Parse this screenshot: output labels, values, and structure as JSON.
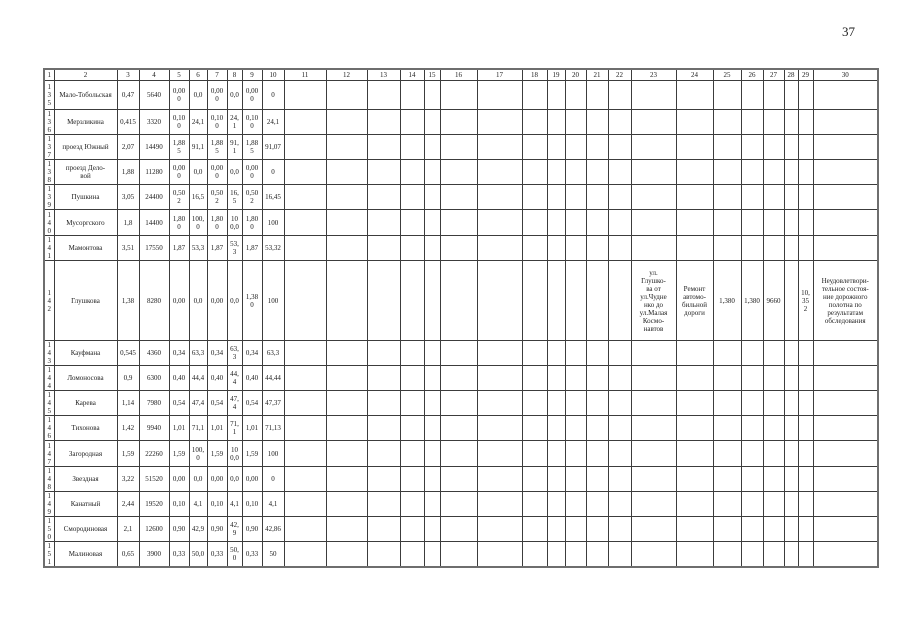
{
  "page": {
    "number": "37"
  },
  "table": {
    "header_cols": [
      "1",
      "2",
      "3",
      "4",
      "5",
      "6",
      "7",
      "8",
      "9",
      "10",
      "11",
      "12",
      "13",
      "14",
      "15",
      "16",
      "17",
      "18",
      "19",
      "20",
      "21",
      "22",
      "23",
      "24",
      "25",
      "26",
      "27",
      "28",
      "29",
      "30"
    ],
    "rows": [
      {
        "cells": [
          "135",
          "Мало-Тобольская",
          "0,47",
          "5640",
          "0,000",
          "0,0",
          "0,000",
          "0,0",
          "0,000",
          "0",
          "",
          "",
          "",
          "",
          "",
          "",
          "",
          "",
          "",
          "",
          "",
          "",
          "",
          "",
          "",
          "",
          "",
          "",
          "",
          ""
        ]
      },
      {
        "cells": [
          "136",
          "Мерзликина",
          "0,415",
          "3320",
          "0,100",
          "24,1",
          "0,100",
          "24,1",
          "0,100",
          "24,1",
          "",
          "",
          "",
          "",
          "",
          "",
          "",
          "",
          "",
          "",
          "",
          "",
          "",
          "",
          "",
          "",
          "",
          "",
          "",
          ""
        ]
      },
      {
        "cells": [
          "137",
          "проезд Южный",
          "2,07",
          "14490",
          "1,885",
          "91,1",
          "1,885",
          "91,1",
          "1,885",
          "91,07",
          "",
          "",
          "",
          "",
          "",
          "",
          "",
          "",
          "",
          "",
          "",
          "",
          "",
          "",
          "",
          "",
          "",
          "",
          "",
          ""
        ]
      },
      {
        "cells": [
          "138",
          "проезд Дело-\nвой",
          "1,88",
          "11280",
          "0,000",
          "0,0",
          "0,000",
          "0,0",
          "0,000",
          "0",
          "",
          "",
          "",
          "",
          "",
          "",
          "",
          "",
          "",
          "",
          "",
          "",
          "",
          "",
          "",
          "",
          "",
          "",
          "",
          ""
        ]
      },
      {
        "cells": [
          "139",
          "Пушкина",
          "3,05",
          "24400",
          "0,502",
          "16,5",
          "0,502",
          "16,5",
          "0,502",
          "16,45",
          "",
          "",
          "",
          "",
          "",
          "",
          "",
          "",
          "",
          "",
          "",
          "",
          "",
          "",
          "",
          "",
          "",
          "",
          "",
          ""
        ]
      },
      {
        "cells": [
          "140",
          "Мусоргского",
          "1,8",
          "14400",
          "1,800",
          "100,0",
          "1,800",
          "100,0",
          "1,800",
          "100",
          "",
          "",
          "",
          "",
          "",
          "",
          "",
          "",
          "",
          "",
          "",
          "",
          "",
          "",
          "",
          "",
          "",
          "",
          "",
          ""
        ]
      },
      {
        "cells": [
          "141",
          "Мамонтова",
          "3,51",
          "17550",
          "1,87",
          "53,3",
          "1,87",
          "53,3",
          "1,87",
          "53,32",
          "",
          "",
          "",
          "",
          "",
          "",
          "",
          "",
          "",
          "",
          "",
          "",
          "",
          "",
          "",
          "",
          "",
          "",
          "",
          ""
        ]
      },
      {
        "cells": [
          "142",
          "Глушкова",
          "1,38",
          "8280",
          "0,00",
          "0,0",
          "0,00",
          "0,0",
          "1,380",
          "100",
          "",
          "",
          "",
          "",
          "",
          "",
          "",
          "",
          "",
          "",
          "",
          "",
          "ул.\nГлушко-\nва от\nул.Чудне\nнко до\nул.Малая\nКосмо-\nнавтов",
          "Ремонт\nавтомо-\nбильной\nдороги",
          "1,380",
          "1,380",
          "9660",
          "",
          "10,352",
          "Неудовлетвори-\nтельное состоя-\nние дорожного\nполотна по\nрезультатам\nобследования"
        ]
      },
      {
        "cells": [
          "143",
          "Кауфмана",
          "0,545",
          "4360",
          "0,34",
          "63,3",
          "0,34",
          "63,3",
          "0,34",
          "63,3",
          "",
          "",
          "",
          "",
          "",
          "",
          "",
          "",
          "",
          "",
          "",
          "",
          "",
          "",
          "",
          "",
          "",
          "",
          "",
          ""
        ]
      },
      {
        "cells": [
          "144",
          "Ломоносова",
          "0,9",
          "6300",
          "0,40",
          "44,4",
          "0,40",
          "44,4",
          "0,40",
          "44,44",
          "",
          "",
          "",
          "",
          "",
          "",
          "",
          "",
          "",
          "",
          "",
          "",
          "",
          "",
          "",
          "",
          "",
          "",
          "",
          ""
        ]
      },
      {
        "cells": [
          "145",
          "Карева",
          "1,14",
          "7980",
          "0,54",
          "47,4",
          "0,54",
          "47,4",
          "0,54",
          "47,37",
          "",
          "",
          "",
          "",
          "",
          "",
          "",
          "",
          "",
          "",
          "",
          "",
          "",
          "",
          "",
          "",
          "",
          "",
          "",
          ""
        ]
      },
      {
        "cells": [
          "146",
          "Тихонова",
          "1,42",
          "9940",
          "1,01",
          "71,1",
          "1,01",
          "71,1",
          "1,01",
          "71,13",
          "",
          "",
          "",
          "",
          "",
          "",
          "",
          "",
          "",
          "",
          "",
          "",
          "",
          "",
          "",
          "",
          "",
          "",
          "",
          ""
        ]
      },
      {
        "cells": [
          "147",
          "Загородная",
          "1,59",
          "22260",
          "1,59",
          "100,0",
          "1,59",
          "100,0",
          "1,59",
          "100",
          "",
          "",
          "",
          "",
          "",
          "",
          "",
          "",
          "",
          "",
          "",
          "",
          "",
          "",
          "",
          "",
          "",
          "",
          "",
          ""
        ]
      },
      {
        "cells": [
          "148",
          "Звездная",
          "3,22",
          "51520",
          "0,00",
          "0,0",
          "0,00",
          "0,0",
          "0,00",
          "0",
          "",
          "",
          "",
          "",
          "",
          "",
          "",
          "",
          "",
          "",
          "",
          "",
          "",
          "",
          "",
          "",
          "",
          "",
          "",
          ""
        ]
      },
      {
        "cells": [
          "149",
          "Канатный",
          "2,44",
          "19520",
          "0,10",
          "4,1",
          "0,10",
          "4,1",
          "0,10",
          "4,1",
          "",
          "",
          "",
          "",
          "",
          "",
          "",
          "",
          "",
          "",
          "",
          "",
          "",
          "",
          "",
          "",
          "",
          "",
          "",
          ""
        ]
      },
      {
        "cells": [
          "150",
          "Смородиновая",
          "2,1",
          "12600",
          "0,90",
          "42,9",
          "0,90",
          "42,9",
          "0,90",
          "42,86",
          "",
          "",
          "",
          "",
          "",
          "",
          "",
          "",
          "",
          "",
          "",
          "",
          "",
          "",
          "",
          "",
          "",
          "",
          "",
          ""
        ]
      },
      {
        "cells": [
          "151",
          "Малиновая",
          "0,65",
          "3900",
          "0,33",
          "50,0",
          "0,33",
          "50,0",
          "0,33",
          "50",
          "",
          "",
          "",
          "",
          "",
          "",
          "",
          "",
          "",
          "",
          "",
          "",
          "",
          "",
          "",
          "",
          "",
          "",
          "",
          ""
        ]
      }
    ]
  }
}
